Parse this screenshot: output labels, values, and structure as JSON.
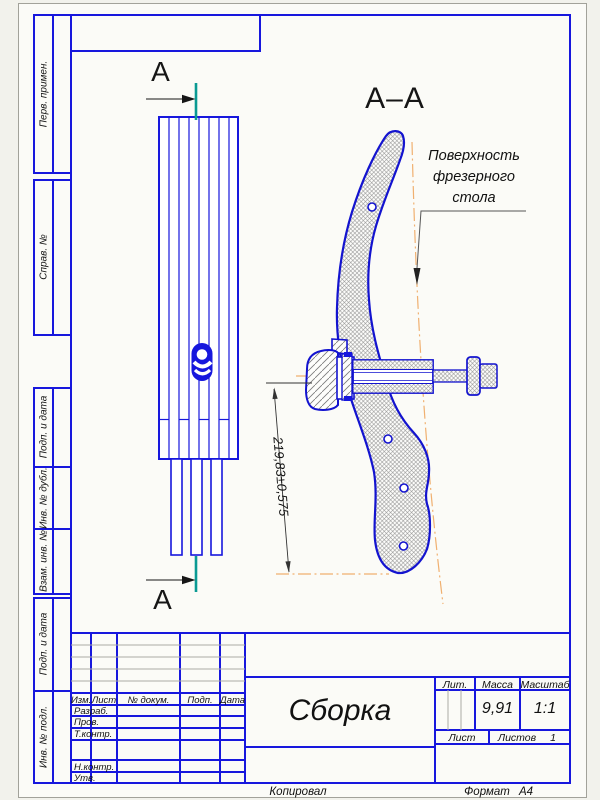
{
  "drawing": {
    "section_mark_top": "А",
    "section_mark_bottom": "А",
    "section_title": "А–А",
    "note_lines": [
      "Поверхность",
      "фрезерного",
      "стола"
    ],
    "dimension": "219,83±0,575"
  },
  "side_strip": {
    "labels": [
      "Перв. примен.",
      "Справ. №",
      "Подп. и дата",
      "Инв. № дубл.",
      "Взам. инв. №",
      "Подп. и дата",
      "Инв. № подл."
    ]
  },
  "title_block": {
    "columns": [
      "Изм.",
      "Лист",
      "№ докум.",
      "Подп.",
      "Дата"
    ],
    "rows": [
      "Разраб.",
      "Пров.",
      "Т.контр.",
      "Н.контр.",
      "Утв."
    ],
    "doc_title": "Сборка",
    "lit_label": "Лит.",
    "mass_label": "Масса",
    "mass_value": "9,91",
    "scale_label": "Масштаб",
    "scale_value": "1:1",
    "sheet_label": "Лист",
    "sheets_label": "Листов",
    "sheets_value": "1"
  },
  "footer": {
    "copied_label": "Копировал",
    "format_label": "Формат",
    "format_value": "А4"
  },
  "colors": {
    "frame_blue": "#1717dd",
    "outline_blue": "#1313cf",
    "section_teal": "#0a9a93",
    "centerline_orange": "#f0b070",
    "hatch_gray": "#8f8f8f"
  }
}
